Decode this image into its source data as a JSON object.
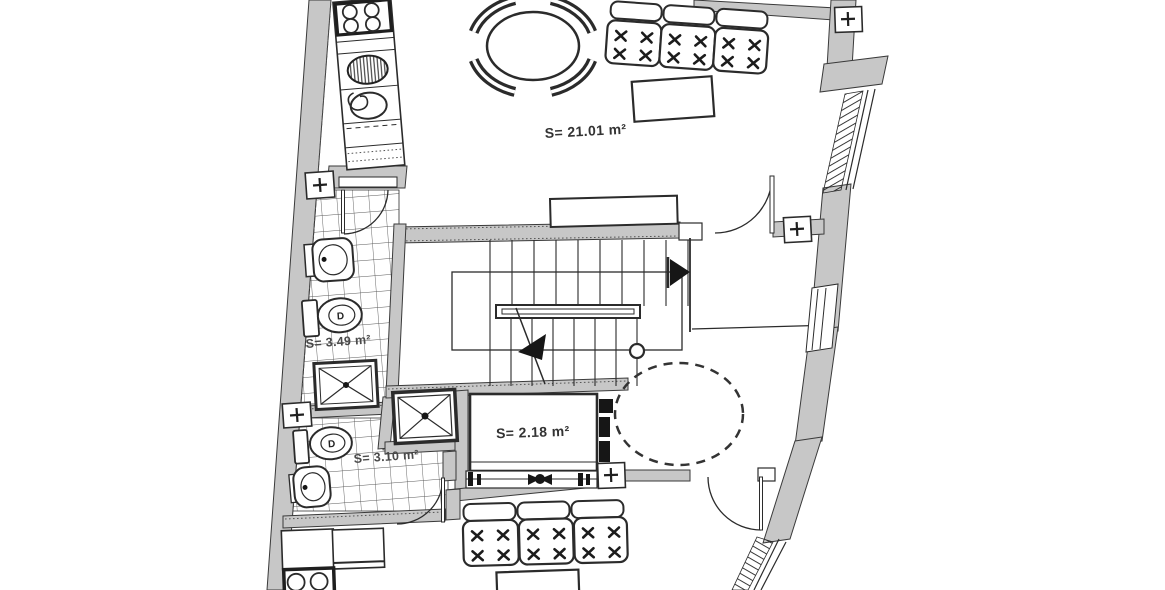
{
  "plan": {
    "title": "apartment-floor-plan",
    "rooms": [
      {
        "id": "living-dining",
        "label": "S= 21.01 m²"
      },
      {
        "id": "bathroom-upper",
        "label": "S= 3.49 m²"
      },
      {
        "id": "elevator",
        "label": "S= 2.18 m²"
      },
      {
        "id": "bathroom-lower",
        "label": "S= 3.10 m²"
      }
    ],
    "toilet_mark": "D",
    "marker_symbol": "+",
    "colors": {
      "background": "#ffffff",
      "wall_fill": "#c7c7c7",
      "line": "#2b2b2b",
      "tile_line": "#5a5a5a"
    },
    "fixtures": [
      "cooktop-icon",
      "kitchen-sink-icon",
      "dining-table-icon",
      "dining-chair-icon",
      "sofa-icon",
      "coffee-table-icon",
      "washbasin-icon",
      "toilet-icon",
      "shower-tray-icon",
      "stairs-icon",
      "handrail-icon",
      "elevator-cabin-icon",
      "turning-circle-icon",
      "door-swing-icon",
      "window-icon",
      "survey-marker-icon"
    ]
  }
}
